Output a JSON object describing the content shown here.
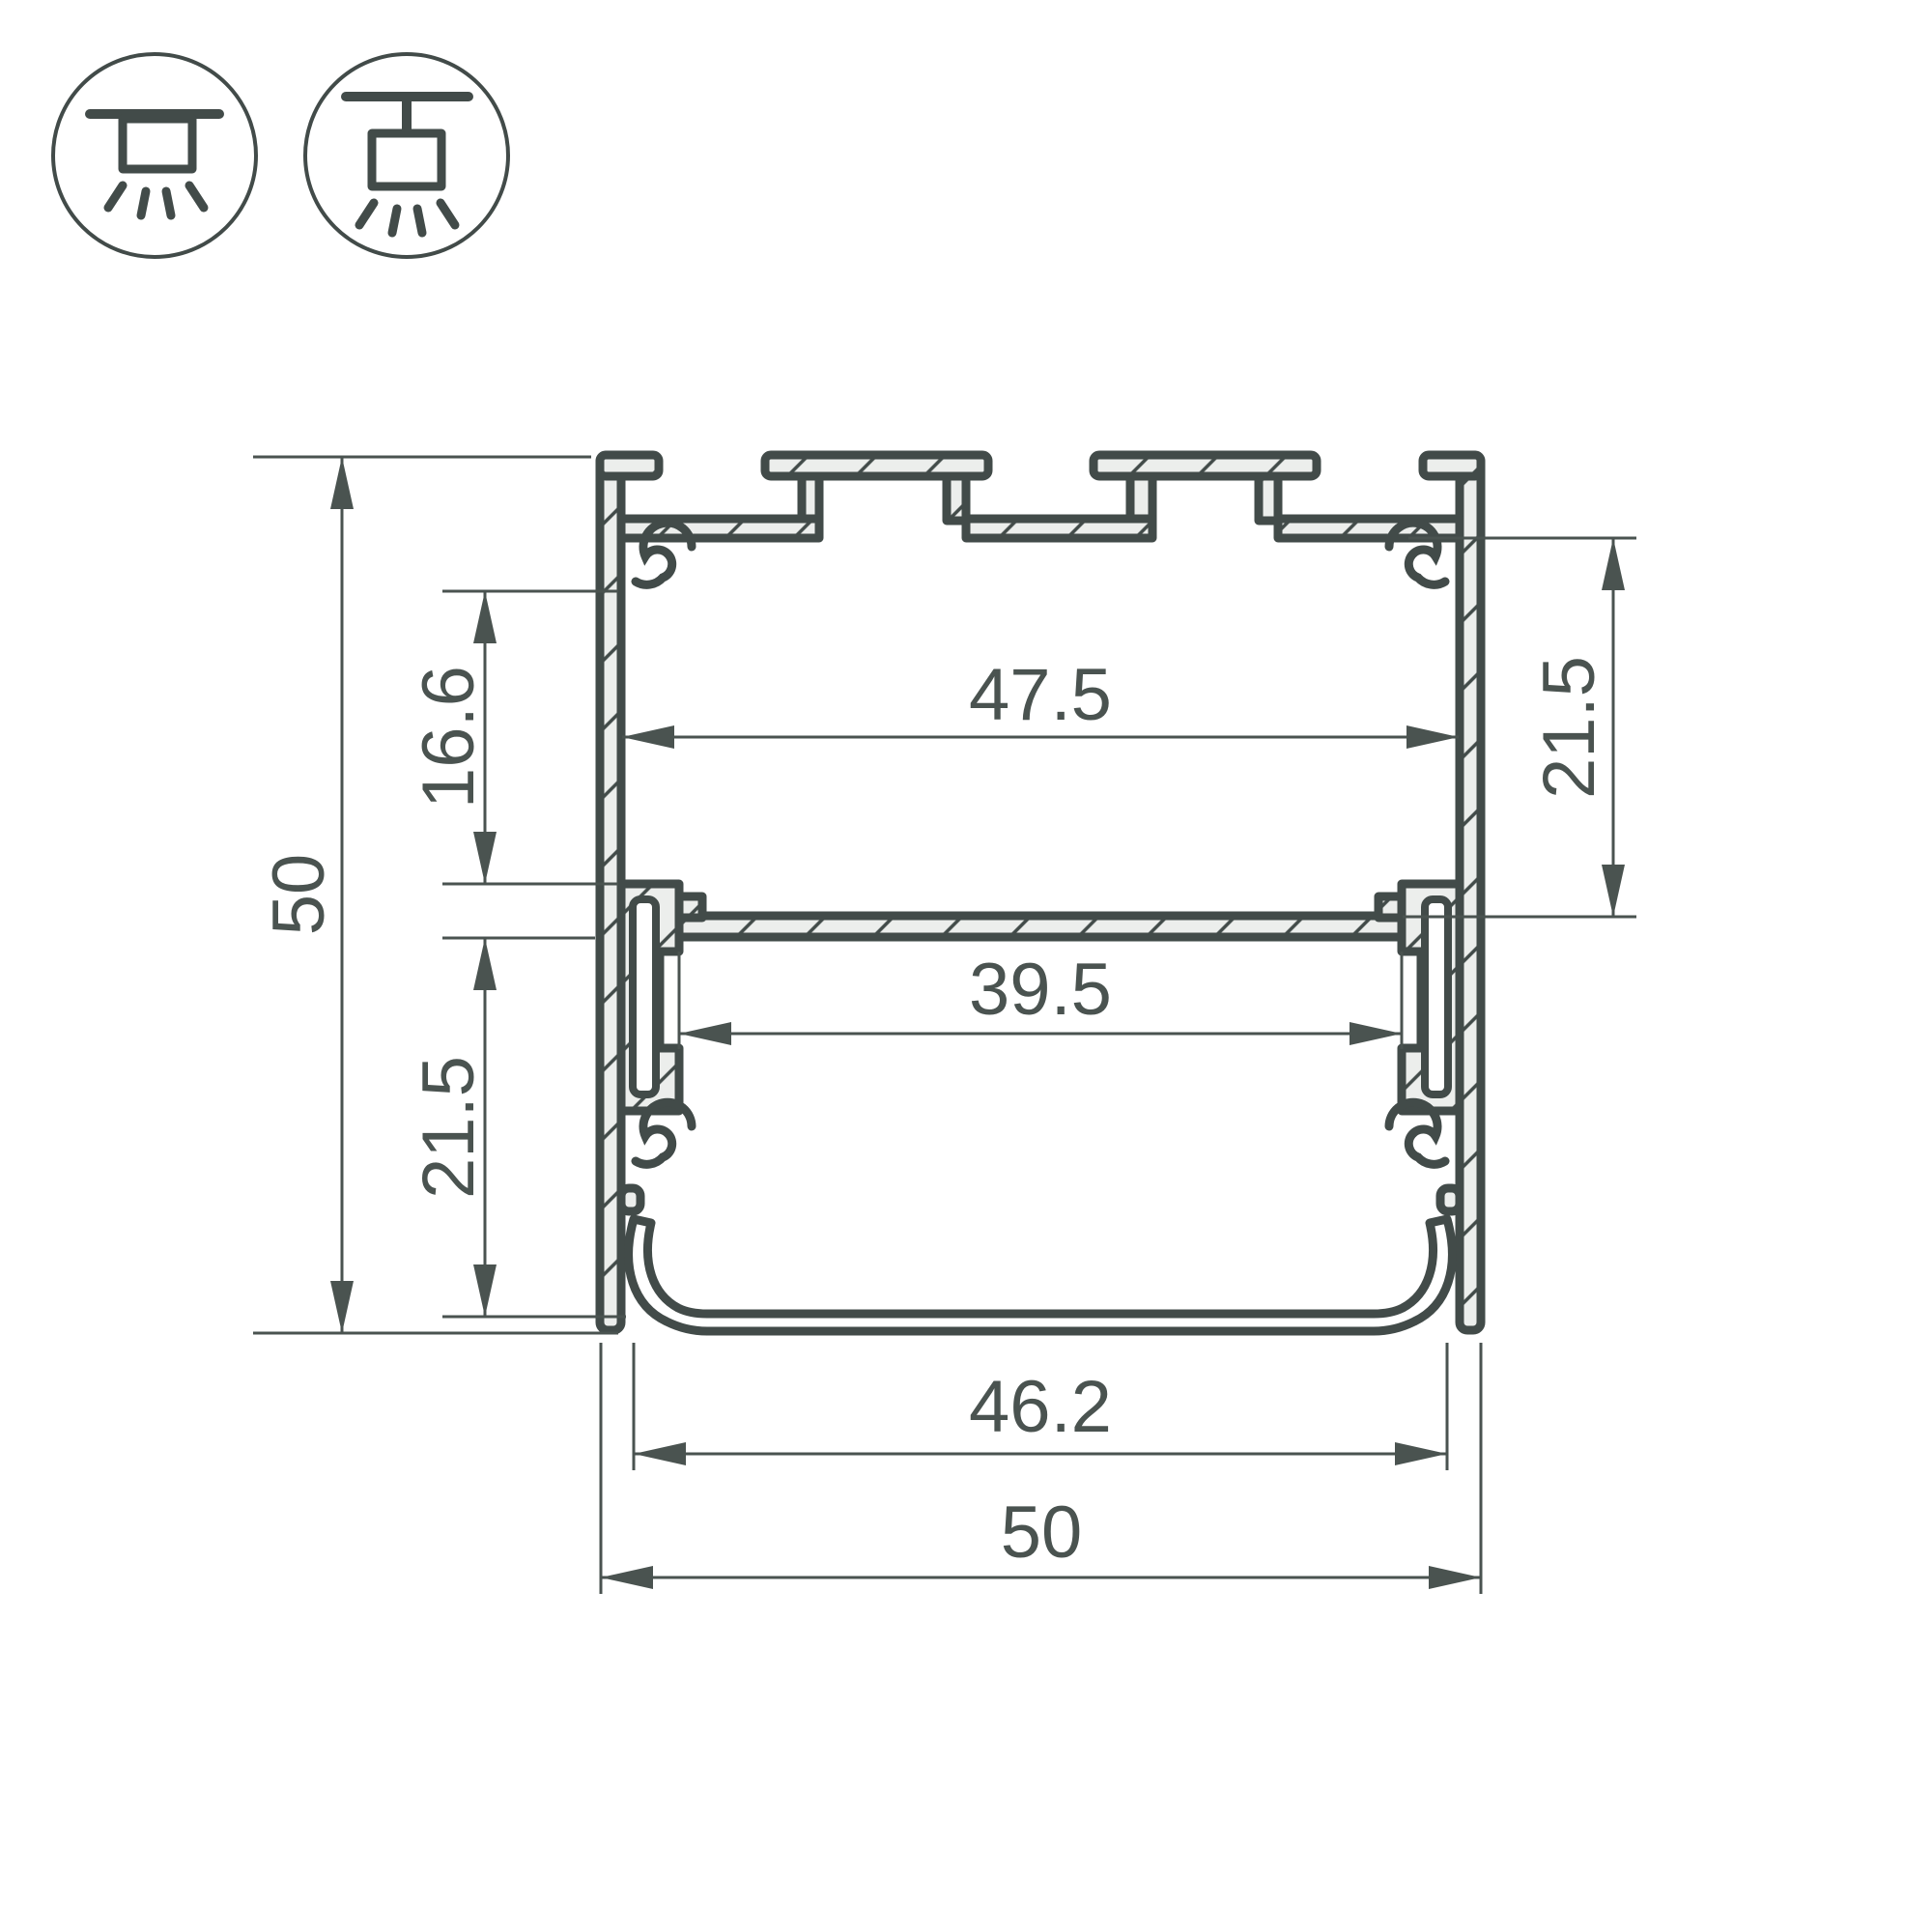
{
  "colors": {
    "line": "#424b49",
    "dim": "#4a5350",
    "fill": "#eceeec",
    "white": "#ffffff"
  },
  "icons": {
    "surface_mount": "surface-mount-icon",
    "pendant_mount": "pendant-mount-icon"
  },
  "dims": {
    "overall_height": "50",
    "upper_inner_height": "16.6",
    "lower_inner_height": "21.5",
    "top_inner_width": "47.5",
    "led_shelf_width": "39.5",
    "right_inner_height": "21.5",
    "diffuser_width": "46.2",
    "overall_width": "50"
  }
}
